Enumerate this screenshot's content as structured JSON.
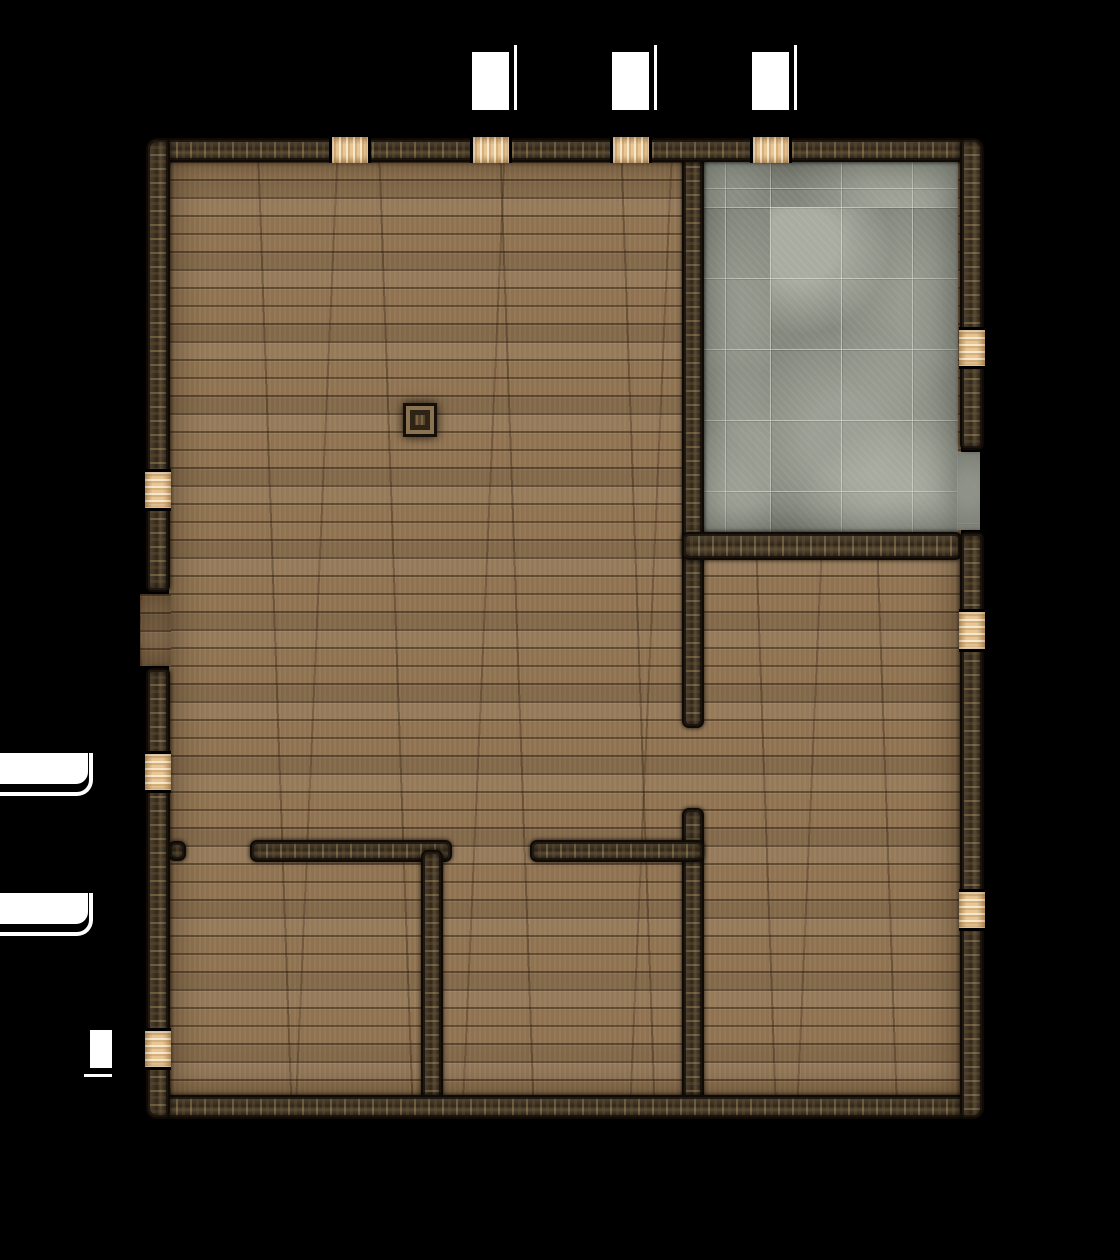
{
  "map": {
    "kind": "tabletop-battle-map-floorplan",
    "background_color": "#000000",
    "colors": {
      "wood_floor": "#8e7251",
      "stone_floor": "#85887d",
      "wall": "#453723",
      "door": "#e8c795",
      "marker": "#ffffff",
      "pillar": "#57452e"
    },
    "counts": {
      "rooms": 5,
      "exterior_doors": 10,
      "wall_openings": 4,
      "white_markers": 6,
      "support_pillars": 1
    },
    "doors": {
      "top_wall": [
        "door-top-1",
        "door-top-2",
        "door-top-3",
        "door-top-4"
      ],
      "left_wall": [
        "door-left-1",
        "door-left-2",
        "door-left-3"
      ],
      "right_wall": [
        "door-right-1",
        "door-right-2",
        "door-right-3"
      ]
    },
    "rooms": [
      "great-hall",
      "stone-tile-room",
      "bottom-right-room",
      "bottom-middle-room",
      "bottom-left-room"
    ]
  }
}
